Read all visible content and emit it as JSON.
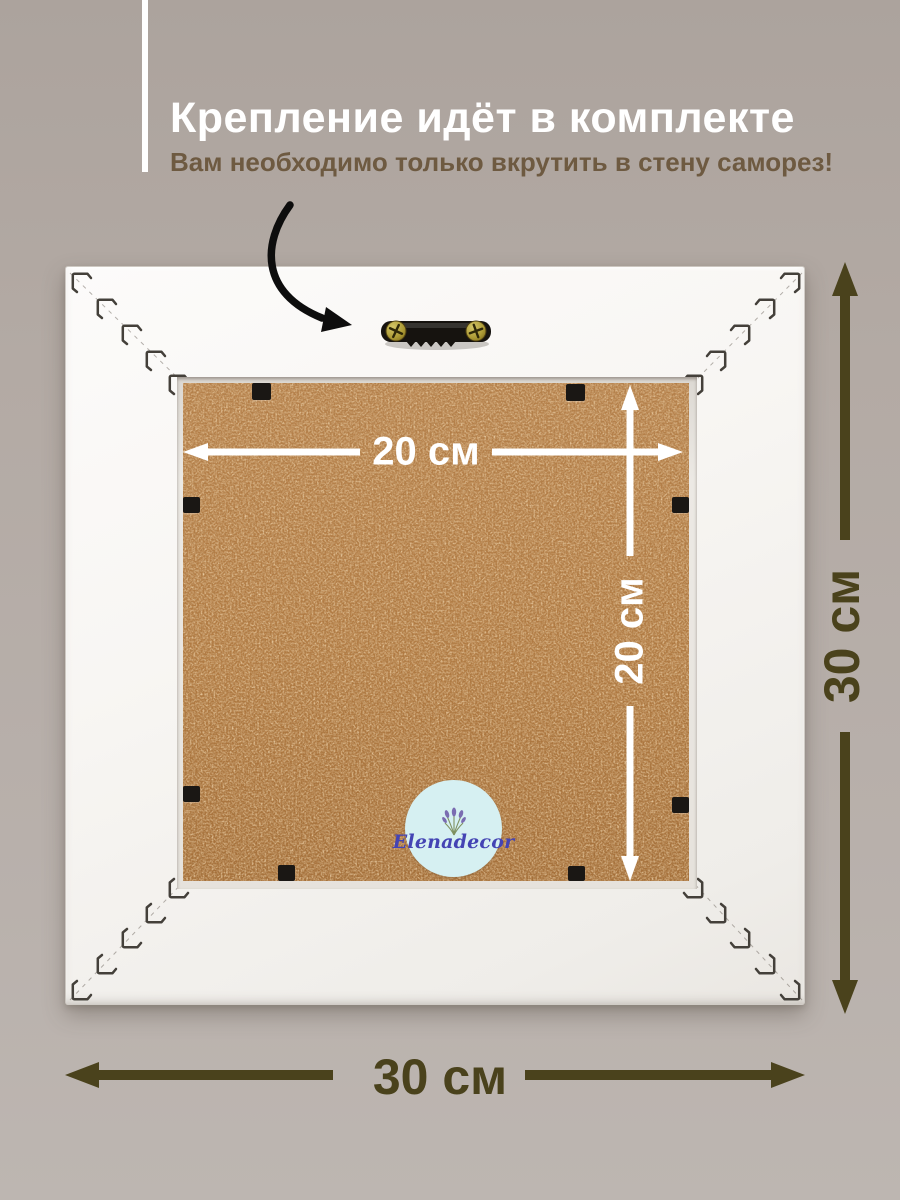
{
  "header": {
    "title": "Крепление идёт в комплекте",
    "subtitle": "Вам необходимо только вкрутить в стену саморез!"
  },
  "frame": {
    "inner_width_label": "20 см",
    "inner_height_label": "20 см",
    "outer_height_label": "30 см",
    "outer_width_label": "30 см"
  },
  "logo": {
    "brand": "Elenadecor"
  },
  "icons": {
    "curved_arrow": "hand-drawn curved black arrow pointing to hanger",
    "sawtooth_hanger": "black sawtooth hanging bracket with two brass screws",
    "v_nail_staples": "miter corner v-nail staples",
    "flexi_clip": "black flexi point clip holding back panel",
    "lavender_sprig": "small lavender bouquet in logo"
  },
  "colors": {
    "bg": "#b3aaa4",
    "subtitle_brown": "#6e5a41",
    "dim_olive": "#4a421c",
    "dim_white": "#ffffff",
    "panel_brown": "#b0783f",
    "frame_white": "#f8f6f3",
    "logo_bg": "#d6f0f2",
    "logo_text": "#4444b4",
    "arrow_black": "#111111"
  }
}
